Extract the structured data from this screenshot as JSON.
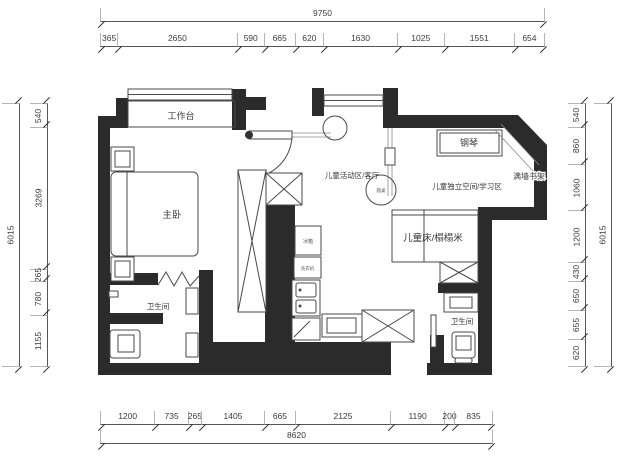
{
  "title": "apartment floor plan",
  "dimensions": {
    "top": {
      "total": "9750",
      "segments": [
        "365",
        "2650",
        "590",
        "665",
        "620",
        "1630",
        "1025",
        "1551",
        "654"
      ]
    },
    "bottom": {
      "total": "8620",
      "segments": [
        "1200",
        "735",
        "265",
        "1405",
        "665",
        "2125",
        "1190",
        "200",
        "835"
      ]
    },
    "left": {
      "total": "6015",
      "segments": [
        "540",
        "3269",
        "265",
        "780",
        "1155"
      ]
    },
    "right": {
      "total": "6015",
      "segments": [
        "540",
        "860",
        "1060",
        "1200",
        "430",
        "650",
        "655",
        "620"
      ]
    }
  },
  "rooms": {
    "worktop": "工作台",
    "master_bedroom": "主卧",
    "bathroom_left": "卫生间",
    "piano": "钢琴",
    "wall_bookshelf": "满墙书架",
    "kids_activity_living": "儿童活动区/客厅",
    "kids_study": "儿童独立空间/学习区",
    "kids_bed_tatami": "儿童床/榻榻米",
    "bathroom_right": "卫生间"
  },
  "fixtures": {
    "fridge": "冰箱",
    "washing_machine": "洗衣机",
    "round_table": "圆桌"
  },
  "colors": {
    "wall": "#2b2b2b",
    "furniture_line": "#4a4a4a",
    "dimension_line": "#555555",
    "text": "#333333",
    "background": "#ffffff"
  }
}
